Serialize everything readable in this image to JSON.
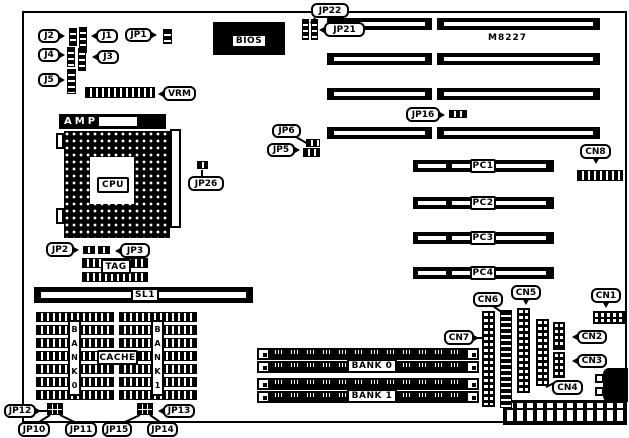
{
  "figure": {
    "kind": "motherboard-layout-diagram",
    "board_model": "M8227",
    "ink": "#000000",
    "paper": "#ffffff"
  },
  "components": [
    {
      "t": "outline",
      "n": "board-outline",
      "x": 22,
      "y": 11,
      "w": 605,
      "h": 412
    },
    {
      "t": "rect",
      "n": "bios-chip-body",
      "x": 213,
      "y": 22,
      "w": 72,
      "h": 33
    },
    {
      "t": "slot",
      "n": "isa-slot-1-left",
      "x": 327,
      "y": 18,
      "w": 105,
      "h": 12
    },
    {
      "t": "slot",
      "n": "isa-slot-1-right",
      "x": 437,
      "y": 18,
      "w": 163,
      "h": 12
    },
    {
      "t": "slot",
      "n": "isa-slot-2-left",
      "x": 327,
      "y": 53,
      "w": 105,
      "h": 12
    },
    {
      "t": "slot",
      "n": "isa-slot-2-right",
      "x": 437,
      "y": 53,
      "w": 163,
      "h": 12
    },
    {
      "t": "slot",
      "n": "isa-slot-3-left",
      "x": 327,
      "y": 88,
      "w": 105,
      "h": 12
    },
    {
      "t": "slot",
      "n": "isa-slot-3-right",
      "x": 437,
      "y": 88,
      "w": 163,
      "h": 12
    },
    {
      "t": "slot",
      "n": "isa-slot-4-left",
      "x": 327,
      "y": 127,
      "w": 105,
      "h": 12
    },
    {
      "t": "slot",
      "n": "isa-slot-4-right",
      "x": 437,
      "y": 127,
      "w": 163,
      "h": 12
    },
    {
      "t": "pcislot",
      "n": "pci-slot-1",
      "x": 413,
      "y": 160,
      "w": 141,
      "h": 12
    },
    {
      "t": "pcislot",
      "n": "pci-slot-2",
      "x": 413,
      "y": 197,
      "w": 141,
      "h": 12
    },
    {
      "t": "pcislot",
      "n": "pci-slot-3",
      "x": 413,
      "y": 232,
      "w": 141,
      "h": 12
    },
    {
      "t": "pcislot",
      "n": "pci-slot-4",
      "x": 413,
      "y": 267,
      "w": 141,
      "h": 12
    },
    {
      "t": "slot",
      "n": "sl1-slot",
      "x": 34,
      "y": 287,
      "w": 219,
      "h": 16
    },
    {
      "t": "simmrow",
      "n": "simm-bank0-row1",
      "x": 257,
      "y": 348,
      "w": 222,
      "h": 12
    },
    {
      "t": "simmrow",
      "n": "simm-bank0-row2",
      "x": 257,
      "y": 361,
      "w": 222,
      "h": 12
    },
    {
      "t": "simmrow",
      "n": "simm-bank1-row1",
      "x": 257,
      "y": 378,
      "w": 222,
      "h": 12
    },
    {
      "t": "simmrow",
      "n": "simm-bank1-row2",
      "x": 257,
      "y": 391,
      "w": 222,
      "h": 12
    },
    {
      "t": "cacheblock",
      "n": "cache-bank0-chips",
      "x": 36,
      "y": 312
    },
    {
      "t": "cacheblock",
      "n": "cache-bank1-chips",
      "x": 119,
      "y": 312
    },
    {
      "t": "socket",
      "n": "cpu-socket",
      "x": 64,
      "y": 131,
      "w": 106,
      "h": 107
    },
    {
      "t": "amp",
      "n": "cpu-socket-amp-bar",
      "l": "AMP",
      "x": 59,
      "y": 114,
      "w": 107,
      "h": 15
    },
    {
      "t": "wrect",
      "n": "cpu-socket-lever",
      "x": 170,
      "y": 129,
      "w": 11,
      "h": 99
    },
    {
      "t": "wrect",
      "n": "cpu-socket-tab-top",
      "x": 56,
      "y": 133,
      "w": 8,
      "h": 16
    },
    {
      "t": "wrect",
      "n": "cpu-socket-tab-bottom",
      "x": 56,
      "y": 208,
      "w": 8,
      "h": 16
    },
    {
      "t": "power",
      "n": "power-connector",
      "x": 503,
      "y": 400,
      "w": 124,
      "h": 25
    },
    {
      "t": "kbrect",
      "n": "keyboard-connector",
      "x": 603,
      "y": 368,
      "w": 25,
      "h": 34
    },
    {
      "t": "wrect",
      "n": "keyboard-tab-top",
      "x": 595,
      "y": 374,
      "w": 9,
      "h": 9
    },
    {
      "t": "wrect",
      "n": "keyboard-tab-bottom",
      "x": 595,
      "y": 387,
      "w": 9,
      "h": 9
    },
    {
      "t": "vstrip",
      "n": "jumper-j2",
      "x": 69,
      "y": 28,
      "w": 8,
      "h": 18
    },
    {
      "t": "vstrip",
      "n": "jumper-j1",
      "x": 79,
      "y": 27,
      "w": 8,
      "h": 26
    },
    {
      "t": "vstrip",
      "n": "jumper-j4",
      "x": 67,
      "y": 47,
      "w": 8,
      "h": 20
    },
    {
      "t": "vstrip",
      "n": "jumper-j3",
      "x": 78,
      "y": 48,
      "w": 8,
      "h": 23
    },
    {
      "t": "vstrip",
      "n": "jumper-j5",
      "x": 67,
      "y": 69,
      "w": 9,
      "h": 25
    },
    {
      "t": "vstrip",
      "n": "jumper-jp1",
      "x": 163,
      "y": 29,
      "w": 9,
      "h": 15
    },
    {
      "t": "vstrip",
      "n": "jumper-jp22-a",
      "x": 302,
      "y": 19,
      "w": 7,
      "h": 21
    },
    {
      "t": "vstrip",
      "n": "jumper-jp22-b",
      "x": 311,
      "y": 19,
      "w": 7,
      "h": 21
    },
    {
      "t": "vstrip",
      "n": "cn6-connector",
      "x": 500,
      "y": 310,
      "w": 12,
      "h": 98
    },
    {
      "t": "hstrip",
      "n": "vrm-connector",
      "x": 85,
      "y": 87,
      "w": 70,
      "h": 11
    },
    {
      "t": "hstrip",
      "n": "jumper-jp16",
      "x": 449,
      "y": 110,
      "w": 18,
      "h": 8
    },
    {
      "t": "hstrip",
      "n": "jumper-jp6",
      "x": 306,
      "y": 139,
      "w": 14,
      "h": 8
    },
    {
      "t": "hstrip",
      "n": "jumper-jp5",
      "x": 303,
      "y": 148,
      "w": 17,
      "h": 9
    },
    {
      "t": "hstrip",
      "n": "jumper-jp26",
      "x": 197,
      "y": 161,
      "w": 11,
      "h": 8
    },
    {
      "t": "hstrip",
      "n": "jumper-jp2",
      "x": 83,
      "y": 246,
      "w": 12,
      "h": 8
    },
    {
      "t": "hstrip",
      "n": "jumper-jp3",
      "x": 98,
      "y": 246,
      "w": 12,
      "h": 8
    },
    {
      "t": "hstrip",
      "n": "tag-chip-row1",
      "x": 82,
      "y": 258,
      "w": 66,
      "h": 10
    },
    {
      "t": "hstrip",
      "n": "tag-chip-row2",
      "x": 82,
      "y": 272,
      "w": 66,
      "h": 10
    },
    {
      "t": "hstrip",
      "n": "cn8-connector",
      "x": 577,
      "y": 170,
      "w": 46,
      "h": 11
    },
    {
      "t": "pins2v",
      "n": "cn7-connector",
      "x": 482,
      "y": 311,
      "w": 13,
      "h": 96
    },
    {
      "t": "pins2v",
      "n": "cn5-connector",
      "x": 517,
      "y": 308,
      "w": 13,
      "h": 85
    },
    {
      "t": "pins2v",
      "n": "cn4-connector",
      "x": 536,
      "y": 319,
      "w": 13,
      "h": 67
    },
    {
      "t": "pins2v",
      "n": "cn2-connector",
      "x": 553,
      "y": 322,
      "w": 12,
      "h": 28
    },
    {
      "t": "pins2v",
      "n": "cn3-connector",
      "x": 553,
      "y": 352,
      "w": 12,
      "h": 26
    },
    {
      "t": "pins2h",
      "n": "cn1-connector",
      "x": 593,
      "y": 311,
      "w": 34,
      "h": 13
    },
    {
      "t": "pinblock",
      "n": "jumper-block-jp10-jp12",
      "x": 47,
      "y": 403,
      "w": 16,
      "h": 12
    },
    {
      "t": "pinblock",
      "n": "jumper-block-jp13-jp15",
      "x": 137,
      "y": 403,
      "w": 16,
      "h": 12
    },
    {
      "t": "line",
      "n": "lead-jp26",
      "x": 202,
      "y": 169,
      "len": 9,
      "ang": 90
    },
    {
      "t": "line",
      "n": "lead-jp10",
      "x": 50,
      "y": 414,
      "len": 17,
      "ang": 147
    },
    {
      "t": "line",
      "n": "lead-jp11",
      "x": 60,
      "y": 414,
      "len": 20,
      "ang": 26
    },
    {
      "t": "line",
      "n": "lead-jp15",
      "x": 140,
      "y": 414,
      "len": 19,
      "ang": 155
    },
    {
      "t": "line",
      "n": "lead-jp14",
      "x": 150,
      "y": 414,
      "len": 15,
      "ang": 35
    },
    {
      "t": "line",
      "n": "lead-cn6",
      "x": 493,
      "y": 305,
      "len": 12,
      "ang": 35
    },
    {
      "t": "line",
      "n": "lead-cn4",
      "x": 554,
      "y": 382,
      "len": 9,
      "ang": 153
    },
    {
      "t": "line",
      "n": "lead-jp6",
      "x": 296,
      "y": 136,
      "len": 12,
      "ang": 30
    },
    {
      "t": "line",
      "n": "lead-cn7",
      "x": 475,
      "y": 337,
      "len": 8,
      "ang": 0
    },
    {
      "t": "line",
      "n": "lead-jp12",
      "x": 37,
      "y": 410,
      "len": 10,
      "ang": 0
    },
    {
      "t": "line",
      "n": "lead-jp22",
      "x": 315,
      "y": 17,
      "len": 7,
      "ang": 129
    },
    {
      "t": "text",
      "n": "board-model-text",
      "l": "M8227",
      "x": 488,
      "y": 33,
      "w": 44,
      "h": 12
    },
    {
      "t": "boxlabel",
      "n": "bios-label",
      "l": "BIOS",
      "x": 231,
      "y": 34,
      "w": 36,
      "h": 14
    },
    {
      "t": "boxlabel",
      "n": "cpu-label",
      "l": "CPU",
      "x": 97,
      "y": 177,
      "w": 32,
      "h": 16
    },
    {
      "t": "boxlabel",
      "n": "tag-label",
      "l": "TAG",
      "x": 101,
      "y": 259,
      "w": 30,
      "h": 15
    },
    {
      "t": "boxlabel",
      "n": "sl1-label",
      "l": "SL1",
      "x": 131,
      "y": 288,
      "w": 28,
      "h": 14
    },
    {
      "t": "boxlabel",
      "n": "pc1-label",
      "l": "PC1",
      "x": 470,
      "y": 159,
      "w": 26,
      "h": 14
    },
    {
      "t": "boxlabel",
      "n": "pc2-label",
      "l": "PC2",
      "x": 470,
      "y": 196,
      "w": 26,
      "h": 14
    },
    {
      "t": "boxlabel",
      "n": "pc3-label",
      "l": "PC3",
      "x": 470,
      "y": 231,
      "w": 26,
      "h": 14
    },
    {
      "t": "boxlabel",
      "n": "pc4-label",
      "l": "PC4",
      "x": 470,
      "y": 266,
      "w": 26,
      "h": 14
    },
    {
      "t": "boxlabel",
      "n": "simm-bank0-label",
      "l": "BANK 0",
      "x": 347,
      "y": 359,
      "w": 50,
      "h": 14
    },
    {
      "t": "boxlabel",
      "n": "simm-bank1-label",
      "l": "BANK 1",
      "x": 347,
      "y": 389,
      "w": 50,
      "h": 14
    },
    {
      "t": "boxlabel",
      "n": "cache-label",
      "l": "CACHE",
      "x": 97,
      "y": 350,
      "w": 41,
      "h": 15
    },
    {
      "t": "vlabel",
      "n": "cache-bank0-label",
      "l": "B\nA\nN\nK\n0",
      "x": 68,
      "y": 320,
      "w": 13,
      "h": 76
    },
    {
      "t": "vlabel",
      "n": "cache-bank1-label",
      "l": "B\nA\nN\nK\n1",
      "x": 151,
      "y": 320,
      "w": 13,
      "h": 76
    },
    {
      "t": "callout",
      "n": "callout-j2",
      "l": "J2",
      "x": 38,
      "y": 29,
      "w": 22,
      "h": 14,
      "tail": "right"
    },
    {
      "t": "callout",
      "n": "callout-j1",
      "l": "J1",
      "x": 96,
      "y": 29,
      "w": 22,
      "h": 14,
      "tail": "left"
    },
    {
      "t": "callout",
      "n": "callout-j4",
      "l": "J4",
      "x": 38,
      "y": 48,
      "w": 22,
      "h": 14,
      "tail": "right"
    },
    {
      "t": "callout",
      "n": "callout-j3",
      "l": "J3",
      "x": 97,
      "y": 50,
      "w": 22,
      "h": 14,
      "tail": "left"
    },
    {
      "t": "callout",
      "n": "callout-j5",
      "l": "J5",
      "x": 38,
      "y": 73,
      "w": 22,
      "h": 14,
      "tail": "right"
    },
    {
      "t": "callout",
      "n": "callout-jp1",
      "l": "JP1",
      "x": 125,
      "y": 28,
      "w": 27,
      "h": 14,
      "tail": "right"
    },
    {
      "t": "callout",
      "n": "callout-jp22",
      "l": "JP22",
      "x": 311,
      "y": 3,
      "w": 38,
      "h": 15,
      "tail": "down"
    },
    {
      "t": "callout",
      "n": "callout-jp21",
      "l": "JP21",
      "x": 324,
      "y": 22,
      "w": 41,
      "h": 15,
      "tail": "left"
    },
    {
      "t": "callout",
      "n": "callout-vrm",
      "l": "VRM",
      "x": 163,
      "y": 86,
      "w": 33,
      "h": 15,
      "tail": "left"
    },
    {
      "t": "callout",
      "n": "callout-jp16",
      "l": "JP16",
      "x": 406,
      "y": 107,
      "w": 34,
      "h": 15,
      "tail": "right"
    },
    {
      "t": "callout",
      "n": "callout-jp6",
      "l": "JP6",
      "x": 272,
      "y": 124,
      "w": 29,
      "h": 14
    },
    {
      "t": "callout",
      "n": "callout-jp5",
      "l": "JP5",
      "x": 267,
      "y": 143,
      "w": 28,
      "h": 14,
      "tail": "right"
    },
    {
      "t": "callout",
      "n": "callout-jp26",
      "l": "JP26",
      "x": 188,
      "y": 176,
      "w": 36,
      "h": 15
    },
    {
      "t": "callout",
      "n": "callout-jp2",
      "l": "JP2",
      "x": 46,
      "y": 242,
      "w": 28,
      "h": 15,
      "tail": "right"
    },
    {
      "t": "callout",
      "n": "callout-jp3",
      "l": "JP3",
      "x": 120,
      "y": 243,
      "w": 30,
      "h": 15,
      "tail": "left"
    },
    {
      "t": "callout",
      "n": "callout-cn8",
      "l": "CN8",
      "x": 580,
      "y": 144,
      "w": 31,
      "h": 15,
      "tail": "down"
    },
    {
      "t": "callout",
      "n": "callout-cn6",
      "l": "CN6",
      "x": 473,
      "y": 292,
      "w": 30,
      "h": 15
    },
    {
      "t": "callout",
      "n": "callout-cn5",
      "l": "CN5",
      "x": 511,
      "y": 285,
      "w": 30,
      "h": 15,
      "tail": "down"
    },
    {
      "t": "callout",
      "n": "callout-cn7",
      "l": "CN7",
      "x": 444,
      "y": 330,
      "w": 30,
      "h": 15,
      "tail": "right"
    },
    {
      "t": "callout",
      "n": "callout-cn4",
      "l": "CN4",
      "x": 552,
      "y": 380,
      "w": 31,
      "h": 15
    },
    {
      "t": "callout",
      "n": "callout-cn2",
      "l": "CN2",
      "x": 577,
      "y": 330,
      "w": 30,
      "h": 14,
      "tail": "left"
    },
    {
      "t": "callout",
      "n": "callout-cn3",
      "l": "CN3",
      "x": 577,
      "y": 354,
      "w": 30,
      "h": 14,
      "tail": "left"
    },
    {
      "t": "callout",
      "n": "callout-cn1",
      "l": "CN1",
      "x": 591,
      "y": 288,
      "w": 30,
      "h": 15,
      "tail": "down"
    },
    {
      "t": "callout",
      "n": "callout-jp12",
      "l": "JP12",
      "x": 4,
      "y": 404,
      "w": 32,
      "h": 14,
      "tail": "right"
    },
    {
      "t": "callout",
      "n": "callout-jp13",
      "l": "JP13",
      "x": 163,
      "y": 404,
      "w": 32,
      "h": 14,
      "tail": "left"
    },
    {
      "t": "callout",
      "n": "callout-jp10",
      "l": "JP10",
      "x": 18,
      "y": 422,
      "w": 32,
      "h": 15
    },
    {
      "t": "callout",
      "n": "callout-jp11",
      "l": "JP11",
      "x": 65,
      "y": 422,
      "w": 32,
      "h": 15
    },
    {
      "t": "callout",
      "n": "callout-jp15",
      "l": "JP15",
      "x": 102,
      "y": 422,
      "w": 30,
      "h": 15
    },
    {
      "t": "callout",
      "n": "callout-jp14",
      "l": "JP14",
      "x": 147,
      "y": 422,
      "w": 31,
      "h": 15
    }
  ]
}
